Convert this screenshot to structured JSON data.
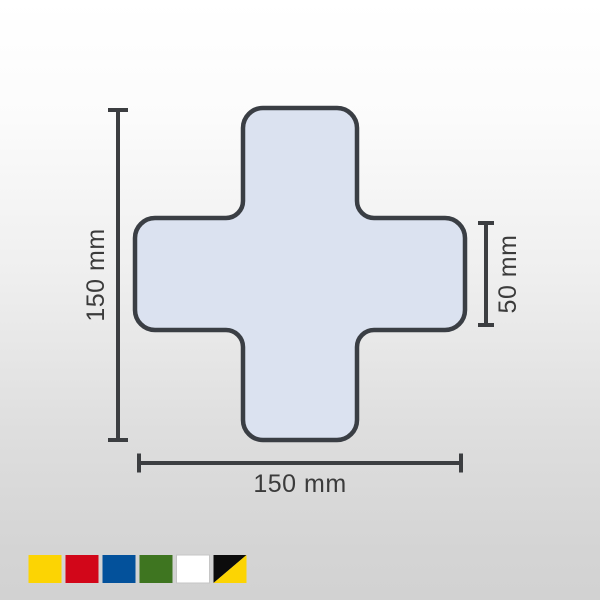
{
  "diagram": {
    "shape": {
      "name": "rounded-cross",
      "fill": "#dbe2f0",
      "stroke": "#3a3e44"
    },
    "dimension_line_color": "#3c3e41",
    "label_color": "#3b3b3b",
    "dimensions": {
      "height": {
        "label": "150 mm"
      },
      "width": {
        "label": "150 mm"
      },
      "arm_width": {
        "label": "50 mm"
      }
    }
  },
  "swatches": [
    {
      "name": "yellow",
      "color": "#fcd403"
    },
    {
      "name": "red",
      "color": "#d20619"
    },
    {
      "name": "blue",
      "color": "#03519b"
    },
    {
      "name": "green",
      "color": "#3e7520"
    },
    {
      "name": "white",
      "color": "#ffffff",
      "border": "#c6c6c6"
    },
    {
      "name": "black-yellow",
      "color_primary": "#0c0c0c",
      "color_secondary": "#fcd403"
    }
  ]
}
